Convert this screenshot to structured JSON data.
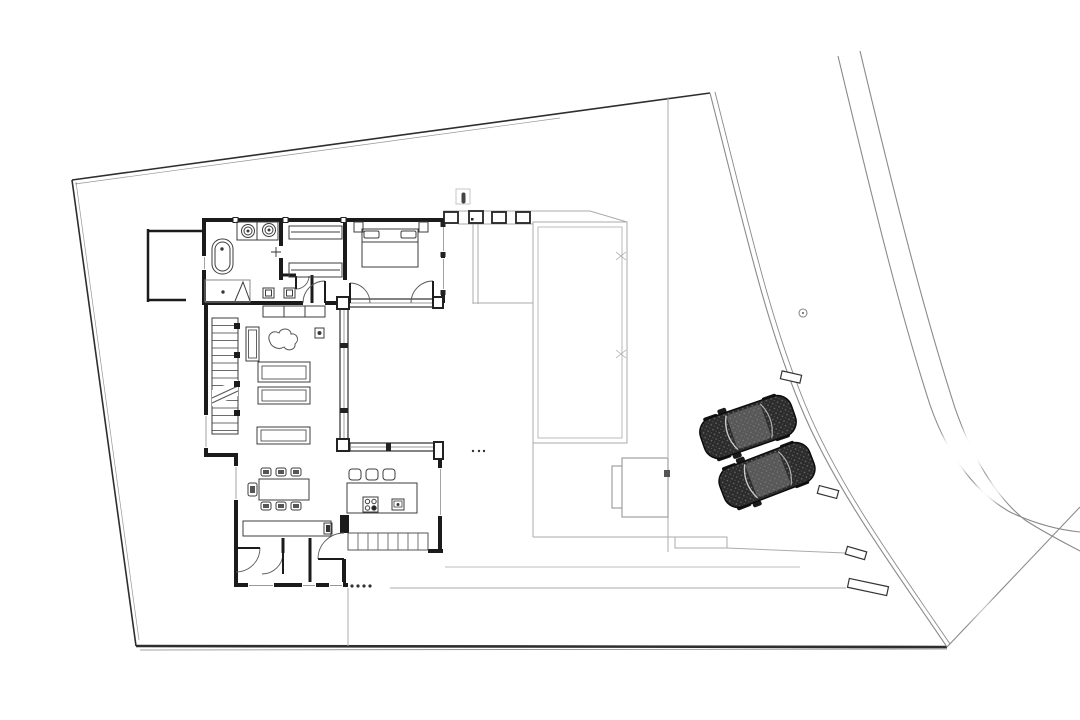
{
  "canvas": {
    "width": 1080,
    "height": 720,
    "background": "#ffffff"
  },
  "palette": {
    "paper": "#ffffff",
    "boundary": "#2e2e2e",
    "road": "#8a8a8a",
    "site_light": "#ababab",
    "wall": "#1b1b1b",
    "door": "#5a5a5a",
    "furniture": "#3c3c3c",
    "glass_mid": "#999999",
    "marker_fill": "#ffffff",
    "marker_stroke": "#333333",
    "car_body": "#2c2c2c",
    "car_dot": "#6d6d6d",
    "car_glass": "#c9c9c9",
    "ink": "#222222"
  },
  "plan": {
    "type": "architectural site / ground-floor plan",
    "view": "top-down black line work on white paper, no text labels",
    "site": {
      "boundary_shape": "irregular quadrilateral plot, road cutting diagonally along right edge",
      "road_bands": 3,
      "gate_markers_count": 4,
      "survey_point_count": 1,
      "path_dots_count": 7
    },
    "house": {
      "shape": "C-shaped house around an east-facing courtyard",
      "master_bathroom": {
        "bathtub": 1,
        "sinks": 2,
        "shower": 1,
        "toilets": 2
      },
      "wardrobe_hall": {
        "closets": 2
      },
      "bedroom": {
        "double_bed": 1,
        "pillows": 2,
        "nightstands": 2,
        "terrace_doors": 2
      },
      "living_room": {
        "stair_flights": 1,
        "stair_treads": 15,
        "sofas": 3,
        "chaise": 1,
        "plant": 1,
        "side_table": 1,
        "sideboard": 1
      },
      "dining": {
        "table": 1,
        "chairs": 7
      },
      "kitchen": {
        "island": 1,
        "bar_stools": 3,
        "cooktop_burners": 4,
        "sink": 1,
        "slider_cells": 8
      },
      "entry_hall": {
        "console": 1,
        "tv_object": 1,
        "interior_door_arcs": 4
      }
    },
    "outdoor": {
      "walled_court": 1,
      "pergola_columns": 4,
      "pool": 1,
      "pool_house": 1,
      "parked_cars": 2
    }
  }
}
